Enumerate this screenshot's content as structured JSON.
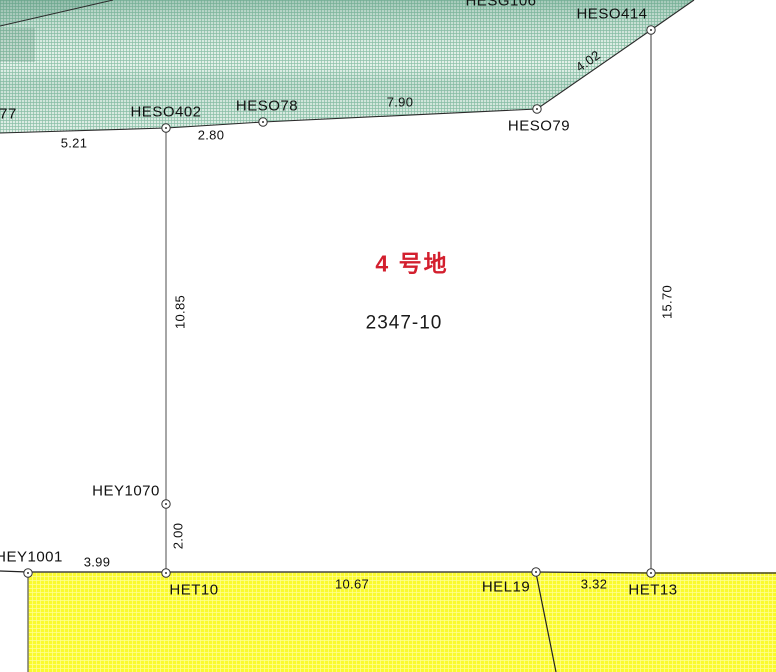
{
  "colors": {
    "label-red": "#d31f2e",
    "line-dark": "#2b2b2b",
    "line-gray": "#8f8f8f",
    "green-base": "#e7f3ec",
    "green-hatch": "#8fc3ab",
    "green-band": "#4f9377",
    "yellow-base": "#fafa2e",
    "yellow-grid": "#ffff96"
  },
  "parcel": {
    "name": "4 号地",
    "number": "2347-10"
  },
  "points": {
    "hesg106": "HESG106",
    "heso414": "HESO414",
    "heso402": "HESO402",
    "heso78": "HESO78",
    "heso79": "HESO79",
    "p77": "77",
    "hey1070": "HEY1070",
    "hey1001": "HEY1001",
    "het10": "HET10",
    "hel19": "HEL19",
    "het13": "HET13"
  },
  "dimensions": {
    "d5_21": "5.21",
    "d2_80": "2.80",
    "d7_90": "7.90",
    "d4_02": "4.02",
    "d10_85": "10.85",
    "d15_70": "15.70",
    "d2_00": "2.00",
    "d3_99": "3.99",
    "d10_67": "10.67",
    "d3_32": "3.32"
  }
}
